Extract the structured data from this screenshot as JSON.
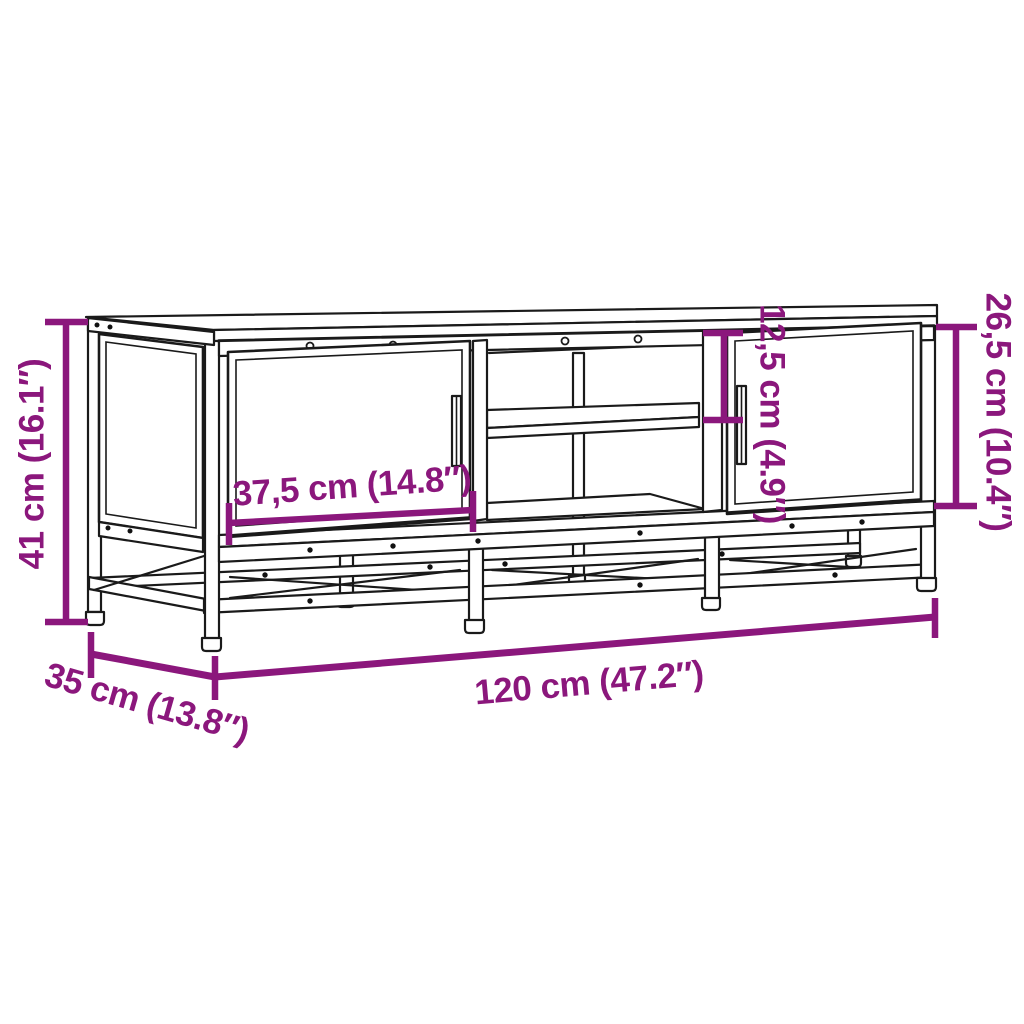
{
  "diagram": {
    "kind": "furniture-dimension-diagram",
    "subject": "TV cabinet with metal frame, two doors and open middle shelf",
    "background_color": "#ffffff",
    "drawing_color": "#1a1a1a",
    "accent_color": "#8B177C"
  },
  "dimensions": {
    "height": {
      "label": "41 cm (16.1″)",
      "cm": 41,
      "inches": 16.1,
      "measures": "overall height"
    },
    "depth": {
      "label": "35 cm (13.8″)",
      "cm": 35,
      "inches": 13.8,
      "measures": "overall depth"
    },
    "width": {
      "label": "120 cm (47.2″)",
      "cm": 120,
      "inches": 47.2,
      "measures": "overall width"
    },
    "door_width": {
      "label": "37,5 cm (14.8″)",
      "cm": 37.5,
      "inches": 14.8,
      "measures": "door width"
    },
    "shelf_height": {
      "label": "12,5 cm (4.9″)",
      "cm": 12.5,
      "inches": 4.9,
      "measures": "upper shelf compartment height"
    },
    "door_height": {
      "label": "26,5 cm (10.4″)",
      "cm": 26.5,
      "inches": 10.4,
      "measures": "door height"
    }
  }
}
